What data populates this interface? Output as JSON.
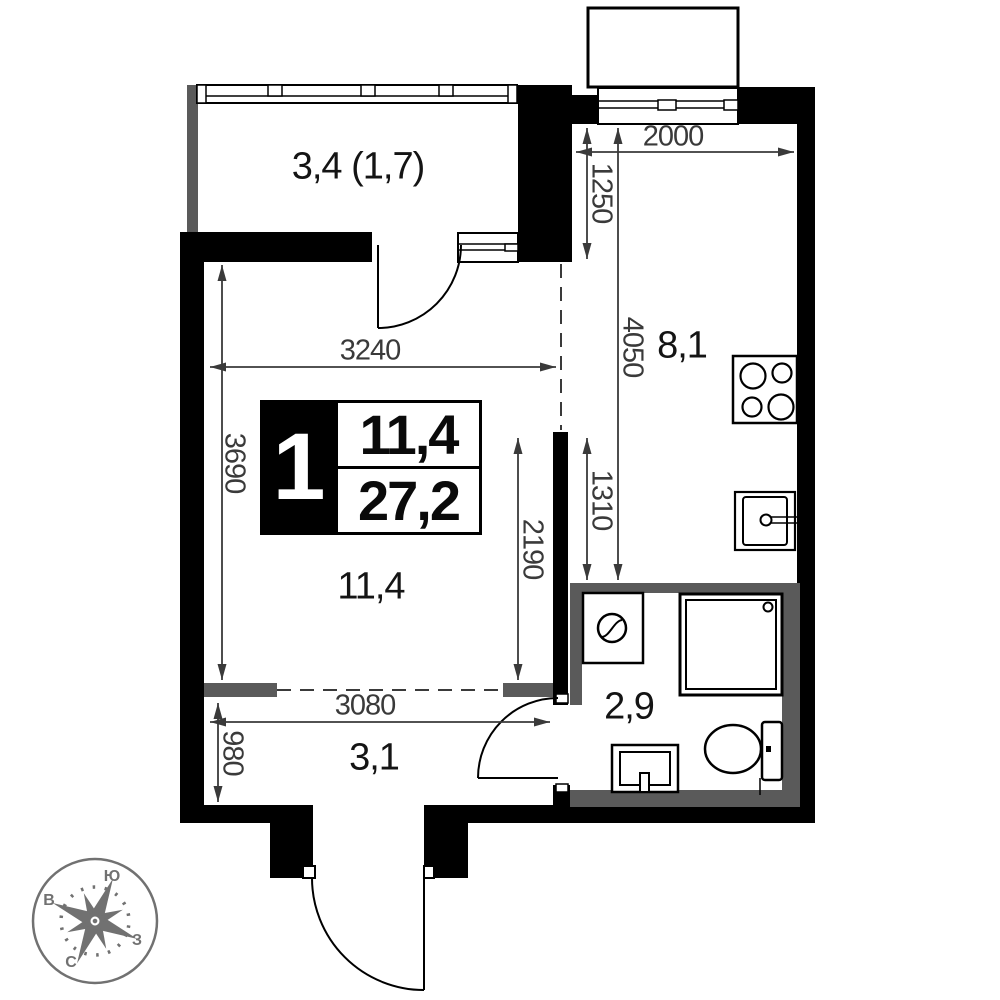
{
  "plan": {
    "info_box": {
      "rooms_count": "1",
      "living_area": "11,4",
      "total_area": "27,2"
    },
    "room_labels": {
      "balcony": "3,4 (1,7)",
      "kitchen": "8,1",
      "living": "11,4",
      "bathroom": "2,9",
      "hallway": "3,1"
    },
    "dimensions": {
      "kitchen_width": "2000",
      "kitchen_window_offset": "1250",
      "kitchen_depth": "4050",
      "living_width": "3240",
      "living_depth": "3690",
      "kitchen_lower_depth": "1310",
      "living_lower_depth": "2190",
      "hallway_width": "3080",
      "hallway_depth": "980"
    },
    "compass": {
      "south": "Ю",
      "west": "В",
      "east": "З",
      "north": "С"
    },
    "colors": {
      "wall": "#000000",
      "partition_wall": "#5a5a5a",
      "dimension": "#3a3a3a",
      "compass": "#717171"
    }
  }
}
